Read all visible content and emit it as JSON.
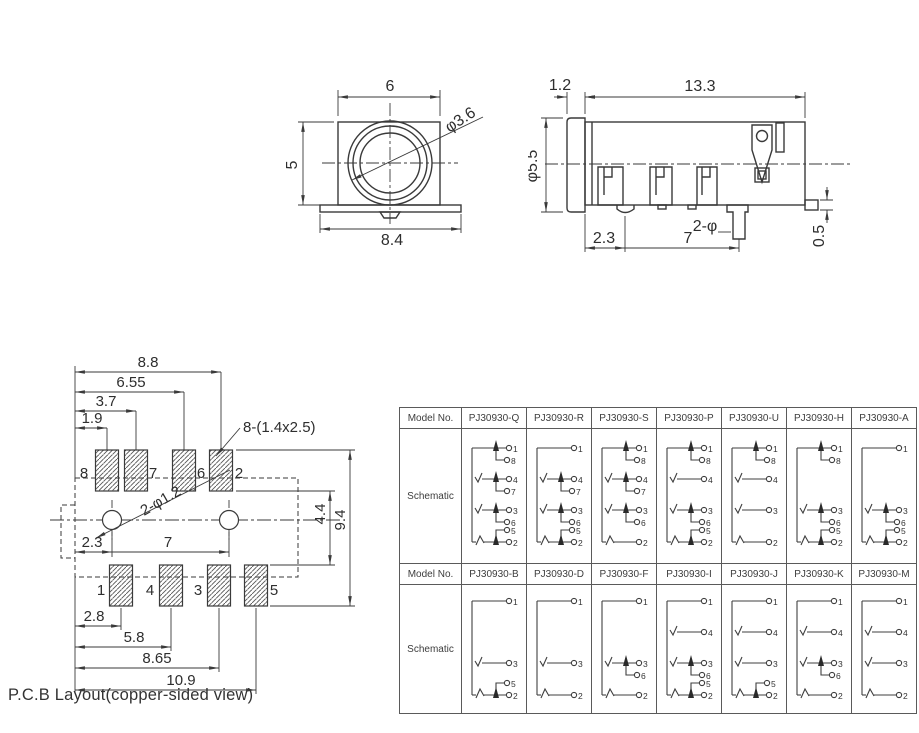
{
  "drawing": {
    "caption": "P.C.B Layout(copper-sided view)",
    "front_view": {
      "width_top": "6",
      "height_left": "5",
      "width_flange": "8.4",
      "jack_dia": "φ3.6"
    },
    "side_view": {
      "flange_thk": "1.2",
      "body_len": "13.3",
      "barrel_dia": "φ5.5",
      "foot_offset": "2.3",
      "post_pitch": "7",
      "post_note": "2-φ",
      "ledge_thk": "0.5"
    },
    "pcb": {
      "pad_note": "8-(1.4x2.5)",
      "hole_note": "2-φ1.2",
      "top_dims": [
        "1.9",
        "3.7",
        "6.55",
        "8.8"
      ],
      "bottom_dims": [
        "2.8",
        "5.8",
        "8.65",
        "10.9"
      ],
      "hole_offset": "2.3",
      "hole_pitch": "7",
      "right_dims": [
        "4.4",
        "9.4"
      ],
      "top_pads": [
        "8",
        "7",
        "6",
        "2"
      ],
      "bottom_pads": [
        "1",
        "4",
        "3",
        "5"
      ]
    }
  },
  "table": {
    "model_label": "Model No.",
    "schematic_label": "Schematic",
    "rows": [
      {
        "models": [
          {
            "name": "PJ30930-Q",
            "groups": [
              [
                1,
                8
              ],
              [
                4,
                7
              ],
              [
                3,
                6
              ],
              [
                2,
                5
              ]
            ]
          },
          {
            "name": "PJ30930-R",
            "groups": [
              [
                1
              ],
              [
                4,
                7
              ],
              [
                3,
                6
              ],
              [
                2,
                5
              ]
            ]
          },
          {
            "name": "PJ30930-S",
            "groups": [
              [
                1,
                8
              ],
              [
                4,
                7
              ],
              [
                3,
                6
              ],
              [
                2
              ]
            ]
          },
          {
            "name": "PJ30930-P",
            "groups": [
              [
                1,
                8
              ],
              [
                4
              ],
              [
                3,
                6
              ],
              [
                2,
                5
              ]
            ]
          },
          {
            "name": "PJ30930-U",
            "groups": [
              [
                1,
                8
              ],
              [
                4
              ],
              [
                3
              ],
              [
                2
              ]
            ]
          },
          {
            "name": "PJ30930-H",
            "groups": [
              [
                1,
                8
              ],
              [
                3,
                6
              ],
              [
                2,
                5
              ]
            ]
          },
          {
            "name": "PJ30930-A",
            "groups": [
              [
                1
              ],
              [
                3,
                6
              ],
              [
                2,
                5
              ]
            ]
          }
        ]
      },
      {
        "models": [
          {
            "name": "PJ30930-B",
            "groups": [
              [
                1
              ],
              [
                3
              ],
              [
                2,
                5
              ]
            ]
          },
          {
            "name": "PJ30930-D",
            "groups": [
              [
                1
              ],
              [
                3
              ],
              [
                2
              ]
            ]
          },
          {
            "name": "PJ30930-F",
            "groups": [
              [
                1
              ],
              [
                3,
                6
              ],
              [
                2
              ]
            ]
          },
          {
            "name": "PJ30930-I",
            "groups": [
              [
                1
              ],
              [
                4
              ],
              [
                3,
                6
              ],
              [
                2,
                5
              ]
            ]
          },
          {
            "name": "PJ30930-J",
            "groups": [
              [
                1
              ],
              [
                4
              ],
              [
                3
              ],
              [
                2,
                5
              ]
            ]
          },
          {
            "name": "PJ30930-K",
            "groups": [
              [
                1
              ],
              [
                4
              ],
              [
                3,
                6
              ],
              [
                2
              ]
            ]
          },
          {
            "name": "PJ30930-M",
            "groups": [
              [
                1
              ],
              [
                4
              ],
              [
                3
              ],
              [
                2
              ]
            ]
          }
        ]
      }
    ]
  }
}
